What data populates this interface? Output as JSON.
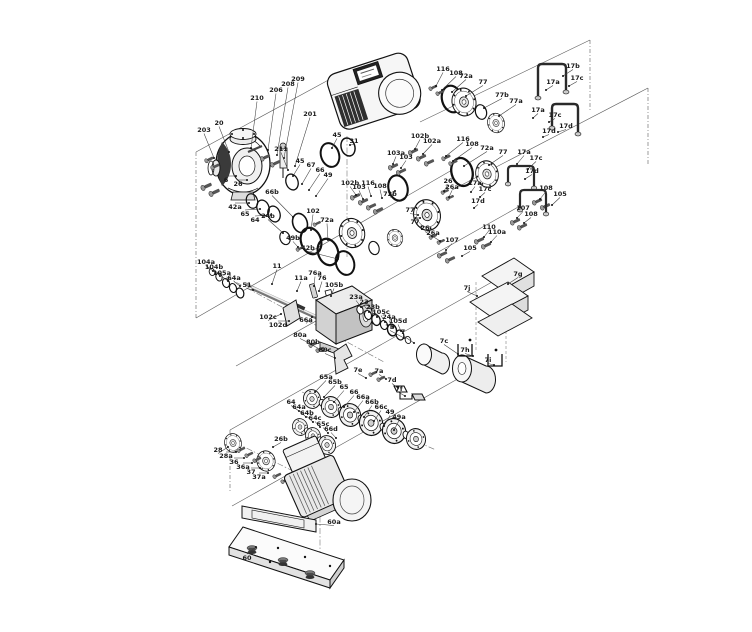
{
  "diagram": {
    "type": "exploded-parts-diagram",
    "subject": "pump-assembly-exploded-view",
    "colors": {
      "line": "#111111",
      "metal_light": "#f2f2f2",
      "metal_mid": "#d8d8d8",
      "metal_dark": "#3a3a3a",
      "background": "#ffffff"
    },
    "labels": [
      {
        "t": "203",
        "x": 204,
        "y": 132,
        "ex": 214,
        "ey": 158
      },
      {
        "t": "20",
        "x": 219,
        "y": 125,
        "ex": 229,
        "ey": 152
      },
      {
        "t": "210",
        "x": 257,
        "y": 100,
        "ex": 251,
        "ey": 148
      },
      {
        "t": "206",
        "x": 276,
        "y": 92,
        "ex": 268,
        "ey": 150
      },
      {
        "t": "208",
        "x": 288,
        "y": 86,
        "ex": 277,
        "ey": 155
      },
      {
        "t": "209",
        "x": 298,
        "y": 81,
        "ex": 284,
        "ey": 158
      },
      {
        "t": "201",
        "x": 310,
        "y": 116,
        "ex": 295,
        "ey": 166
      },
      {
        "t": "211",
        "x": 281,
        "y": 151,
        "ex": 288,
        "ey": 170
      },
      {
        "t": "6",
        "x": 226,
        "y": 182,
        "ex": 236,
        "ey": 176
      },
      {
        "t": "26",
        "x": 238,
        "y": 186,
        "ex": 247,
        "ey": 180
      },
      {
        "t": "45",
        "x": 337,
        "y": 137,
        "ex": 332,
        "ey": 148
      },
      {
        "t": "31",
        "x": 354,
        "y": 143,
        "ex": 350,
        "ey": 145
      },
      {
        "t": "45",
        "x": 300,
        "y": 163,
        "ex": 293,
        "ey": 176
      },
      {
        "t": "67",
        "x": 311,
        "y": 167,
        "ex": 302,
        "ey": 184
      },
      {
        "t": "66",
        "x": 320,
        "y": 172,
        "ex": 309,
        "ey": 190
      },
      {
        "t": "49",
        "x": 328,
        "y": 177,
        "ex": 316,
        "ey": 196
      },
      {
        "t": "66b",
        "x": 272,
        "y": 194,
        "ex": 293,
        "ey": 217
      },
      {
        "t": "42a",
        "x": 235,
        "y": 209,
        "ex": 249,
        "ey": 203
      },
      {
        "t": "65",
        "x": 245,
        "y": 216,
        "ex": 260,
        "ey": 209
      },
      {
        "t": "64",
        "x": 255,
        "y": 222,
        "ex": 271,
        "ey": 215
      },
      {
        "t": "102",
        "x": 313,
        "y": 213,
        "ex": 311,
        "ey": 230
      },
      {
        "t": "72a",
        "x": 327,
        "y": 222,
        "ex": 328,
        "ey": 240
      },
      {
        "t": "24b",
        "x": 268,
        "y": 218,
        "ex": 283,
        "ey": 233
      },
      {
        "t": "49b",
        "x": 293,
        "y": 240,
        "ex": 298,
        "ey": 247
      },
      {
        "t": "42b",
        "x": 308,
        "y": 250,
        "ex": 338,
        "ey": 259
      },
      {
        "t": "102b",
        "x": 350,
        "y": 185,
        "ex": 356,
        "ey": 195
      },
      {
        "t": "103",
        "x": 359,
        "y": 189,
        "ex": 363,
        "ey": 199
      },
      {
        "t": "116",
        "x": 368,
        "y": 185,
        "ex": 371,
        "ey": 196
      },
      {
        "t": "108",
        "x": 380,
        "y": 188,
        "ex": 382,
        "ey": 198
      },
      {
        "t": "72b",
        "x": 390,
        "y": 196,
        "ex": 395,
        "ey": 191
      },
      {
        "t": "77",
        "x": 410,
        "y": 212,
        "ex": 418,
        "ey": 215
      },
      {
        "t": "116",
        "x": 443,
        "y": 71,
        "ex": 436,
        "ey": 86
      },
      {
        "t": "108",
        "x": 456,
        "y": 75,
        "ex": 442,
        "ey": 90
      },
      {
        "t": "72a",
        "x": 466,
        "y": 78,
        "ex": 452,
        "ey": 92
      },
      {
        "t": "77",
        "x": 483,
        "y": 84,
        "ex": 466,
        "ey": 96
      },
      {
        "t": "77b",
        "x": 502,
        "y": 97,
        "ex": 484,
        "ey": 108
      },
      {
        "t": "77a",
        "x": 516,
        "y": 103,
        "ex": 499,
        "ey": 116
      },
      {
        "t": "17b",
        "x": 573,
        "y": 68,
        "ex": 563,
        "ey": 76
      },
      {
        "t": "17c",
        "x": 577,
        "y": 80,
        "ex": 569,
        "ey": 86
      },
      {
        "t": "17a",
        "x": 553,
        "y": 84,
        "ex": 546,
        "ey": 90
      },
      {
        "t": "17a",
        "x": 538,
        "y": 112,
        "ex": 533,
        "ey": 118
      },
      {
        "t": "17c",
        "x": 555,
        "y": 117,
        "ex": 549,
        "ey": 122
      },
      {
        "t": "17d",
        "x": 566,
        "y": 128,
        "ex": 558,
        "ey": 132
      },
      {
        "t": "17d",
        "x": 549,
        "y": 133,
        "ex": 543,
        "ey": 137
      },
      {
        "t": "102b",
        "x": 420,
        "y": 138,
        "ex": 415,
        "ey": 149
      },
      {
        "t": "102a",
        "x": 432,
        "y": 143,
        "ex": 423,
        "ey": 154
      },
      {
        "t": "103a",
        "x": 396,
        "y": 155,
        "ex": 393,
        "ey": 164
      },
      {
        "t": "103",
        "x": 406,
        "y": 159,
        "ex": 401,
        "ey": 168
      },
      {
        "t": "116",
        "x": 463,
        "y": 141,
        "ex": 446,
        "ey": 156
      },
      {
        "t": "108",
        "x": 472,
        "y": 146,
        "ex": 453,
        "ey": 161
      },
      {
        "t": "72a",
        "x": 487,
        "y": 150,
        "ex": 464,
        "ey": 166
      },
      {
        "t": "77",
        "x": 503,
        "y": 154,
        "ex": 489,
        "ey": 165
      },
      {
        "t": "17a",
        "x": 524,
        "y": 154,
        "ex": 517,
        "ey": 164
      },
      {
        "t": "17c",
        "x": 536,
        "y": 160,
        "ex": 528,
        "ey": 169
      },
      {
        "t": "17d",
        "x": 532,
        "y": 173,
        "ex": 525,
        "ey": 179
      },
      {
        "t": "17a",
        "x": 475,
        "y": 185,
        "ex": 471,
        "ey": 192
      },
      {
        "t": "17c",
        "x": 485,
        "y": 191,
        "ex": 480,
        "ey": 197
      },
      {
        "t": "17d",
        "x": 478,
        "y": 203,
        "ex": 474,
        "ey": 208
      },
      {
        "t": "26",
        "x": 448,
        "y": 183,
        "ex": 444,
        "ey": 191
      },
      {
        "t": "26a",
        "x": 452,
        "y": 189,
        "ex": 449,
        "ey": 197
      },
      {
        "t": "77",
        "x": 415,
        "y": 224,
        "ex": 420,
        "ey": 218
      },
      {
        "t": "26",
        "x": 425,
        "y": 230,
        "ex": 432,
        "ey": 236
      },
      {
        "t": "26a",
        "x": 433,
        "y": 235,
        "ex": 440,
        "ey": 241
      },
      {
        "t": "108",
        "x": 546,
        "y": 190,
        "ex": 540,
        "ey": 199
      },
      {
        "t": "105",
        "x": 560,
        "y": 196,
        "ex": 552,
        "ey": 205
      },
      {
        "t": "107",
        "x": 523,
        "y": 210,
        "ex": 517,
        "ey": 218
      },
      {
        "t": "108",
        "x": 531,
        "y": 216,
        "ex": 524,
        "ey": 223
      },
      {
        "t": "110",
        "x": 489,
        "y": 229,
        "ex": 484,
        "ey": 237
      },
      {
        "t": "110a",
        "x": 497,
        "y": 234,
        "ex": 491,
        "ey": 242
      },
      {
        "t": "107",
        "x": 452,
        "y": 242,
        "ex": 446,
        "ey": 250
      },
      {
        "t": "105",
        "x": 470,
        "y": 250,
        "ex": 462,
        "ey": 256
      },
      {
        "t": "104a",
        "x": 206,
        "y": 264,
        "ex": 213,
        "ey": 271
      },
      {
        "t": "104b",
        "x": 214,
        "y": 269,
        "ex": 220,
        "ey": 276
      },
      {
        "t": "105a",
        "x": 222,
        "y": 275,
        "ex": 228,
        "ey": 281
      },
      {
        "t": "64a",
        "x": 234,
        "y": 280,
        "ex": 240,
        "ey": 286
      },
      {
        "t": "51",
        "x": 247,
        "y": 287,
        "ex": 253,
        "ey": 290
      },
      {
        "t": "11",
        "x": 277,
        "y": 268,
        "ex": 272,
        "ey": 284
      },
      {
        "t": "11a",
        "x": 301,
        "y": 280,
        "ex": 297,
        "ey": 291
      },
      {
        "t": "76a",
        "x": 315,
        "y": 275,
        "ex": 314,
        "ey": 286
      },
      {
        "t": "76",
        "x": 322,
        "y": 280,
        "ex": 319,
        "ey": 291
      },
      {
        "t": "105b",
        "x": 334,
        "y": 287,
        "ex": 331,
        "ey": 296
      },
      {
        "t": "102c",
        "x": 268,
        "y": 319,
        "ex": 281,
        "ey": 314
      },
      {
        "t": "102d",
        "x": 278,
        "y": 327,
        "ex": 289,
        "ey": 321
      },
      {
        "t": "66a",
        "x": 306,
        "y": 322,
        "ex": 312,
        "ey": 317
      },
      {
        "t": "80a",
        "x": 300,
        "y": 337,
        "ex": 311,
        "ey": 344
      },
      {
        "t": "80b",
        "x": 313,
        "y": 344,
        "ex": 323,
        "ey": 351
      },
      {
        "t": "80c",
        "x": 325,
        "y": 352,
        "ex": 335,
        "ey": 358
      },
      {
        "t": "23a",
        "x": 356,
        "y": 299,
        "ex": 361,
        "ey": 307
      },
      {
        "t": "23",
        "x": 364,
        "y": 304,
        "ex": 369,
        "ey": 312
      },
      {
        "t": "23b",
        "x": 373,
        "y": 309,
        "ex": 377,
        "ey": 317
      },
      {
        "t": "105c",
        "x": 381,
        "y": 314,
        "ex": 385,
        "ey": 322
      },
      {
        "t": "24a",
        "x": 389,
        "y": 319,
        "ex": 393,
        "ey": 327
      },
      {
        "t": "105d",
        "x": 398,
        "y": 323,
        "ex": 401,
        "ey": 331
      },
      {
        "t": "7b",
        "x": 390,
        "y": 329,
        "ex": 404,
        "ey": 338
      },
      {
        "t": "7",
        "x": 403,
        "y": 334,
        "ex": 414,
        "ey": 343
      },
      {
        "t": "7c",
        "x": 444,
        "y": 343,
        "ex": 458,
        "ey": 354
      },
      {
        "t": "7e",
        "x": 358,
        "y": 372,
        "ex": 366,
        "ey": 378
      },
      {
        "t": "7a",
        "x": 379,
        "y": 373,
        "ex": 386,
        "ey": 379
      },
      {
        "t": "7d",
        "x": 392,
        "y": 382,
        "ex": 398,
        "ey": 388
      },
      {
        "t": "7f",
        "x": 399,
        "y": 391,
        "ex": 405,
        "ey": 396
      },
      {
        "t": "7g",
        "x": 518,
        "y": 276,
        "ex": 508,
        "ey": 284
      },
      {
        "t": "7j",
        "x": 467,
        "y": 290,
        "ex": 477,
        "ey": 296
      },
      {
        "t": "7h",
        "x": 465,
        "y": 352,
        "ex": 473,
        "ey": 356
      },
      {
        "t": "7i",
        "x": 488,
        "y": 362,
        "ex": 494,
        "ey": 365
      },
      {
        "t": "65a",
        "x": 326,
        "y": 379,
        "ex": 315,
        "ey": 392
      },
      {
        "t": "65b",
        "x": 335,
        "y": 384,
        "ex": 324,
        "ey": 397
      },
      {
        "t": "65",
        "x": 344,
        "y": 389,
        "ex": 334,
        "ey": 402
      },
      {
        "t": "66",
        "x": 354,
        "y": 394,
        "ex": 344,
        "ey": 407
      },
      {
        "t": "66a",
        "x": 363,
        "y": 399,
        "ex": 354,
        "ey": 412
      },
      {
        "t": "66b",
        "x": 372,
        "y": 404,
        "ex": 364,
        "ey": 417
      },
      {
        "t": "66c",
        "x": 381,
        "y": 409,
        "ex": 374,
        "ey": 421
      },
      {
        "t": "49",
        "x": 390,
        "y": 414,
        "ex": 384,
        "ey": 426
      },
      {
        "t": "49a",
        "x": 399,
        "y": 419,
        "ex": 394,
        "ey": 430
      },
      {
        "t": "64",
        "x": 291,
        "y": 404,
        "ex": 299,
        "ey": 411
      },
      {
        "t": "64a",
        "x": 299,
        "y": 409,
        "ex": 306,
        "ey": 417
      },
      {
        "t": "64b",
        "x": 307,
        "y": 415,
        "ex": 313,
        "ey": 422
      },
      {
        "t": "64c",
        "x": 315,
        "y": 420,
        "ex": 320,
        "ey": 427
      },
      {
        "t": "65c",
        "x": 323,
        "y": 426,
        "ex": 328,
        "ey": 433
      },
      {
        "t": "66d",
        "x": 331,
        "y": 431,
        "ex": 336,
        "ey": 438
      },
      {
        "t": "26b",
        "x": 281,
        "y": 441,
        "ex": 273,
        "ey": 447
      },
      {
        "t": "28",
        "x": 218,
        "y": 452,
        "ex": 228,
        "ey": 447
      },
      {
        "t": "28a",
        "x": 226,
        "y": 458,
        "ex": 236,
        "ey": 452
      },
      {
        "t": "36",
        "x": 234,
        "y": 464,
        "ex": 244,
        "ey": 458
      },
      {
        "t": "36a",
        "x": 243,
        "y": 469,
        "ex": 252,
        "ey": 463
      },
      {
        "t": "37",
        "x": 251,
        "y": 474,
        "ex": 260,
        "ey": 468
      },
      {
        "t": "37a",
        "x": 259,
        "y": 479,
        "ex": 268,
        "ey": 473
      },
      {
        "t": "60a",
        "x": 334,
        "y": 524,
        "ex": 316,
        "ey": 524
      },
      {
        "t": "60",
        "x": 247,
        "y": 560,
        "ex": 256,
        "ey": 547
      }
    ]
  }
}
